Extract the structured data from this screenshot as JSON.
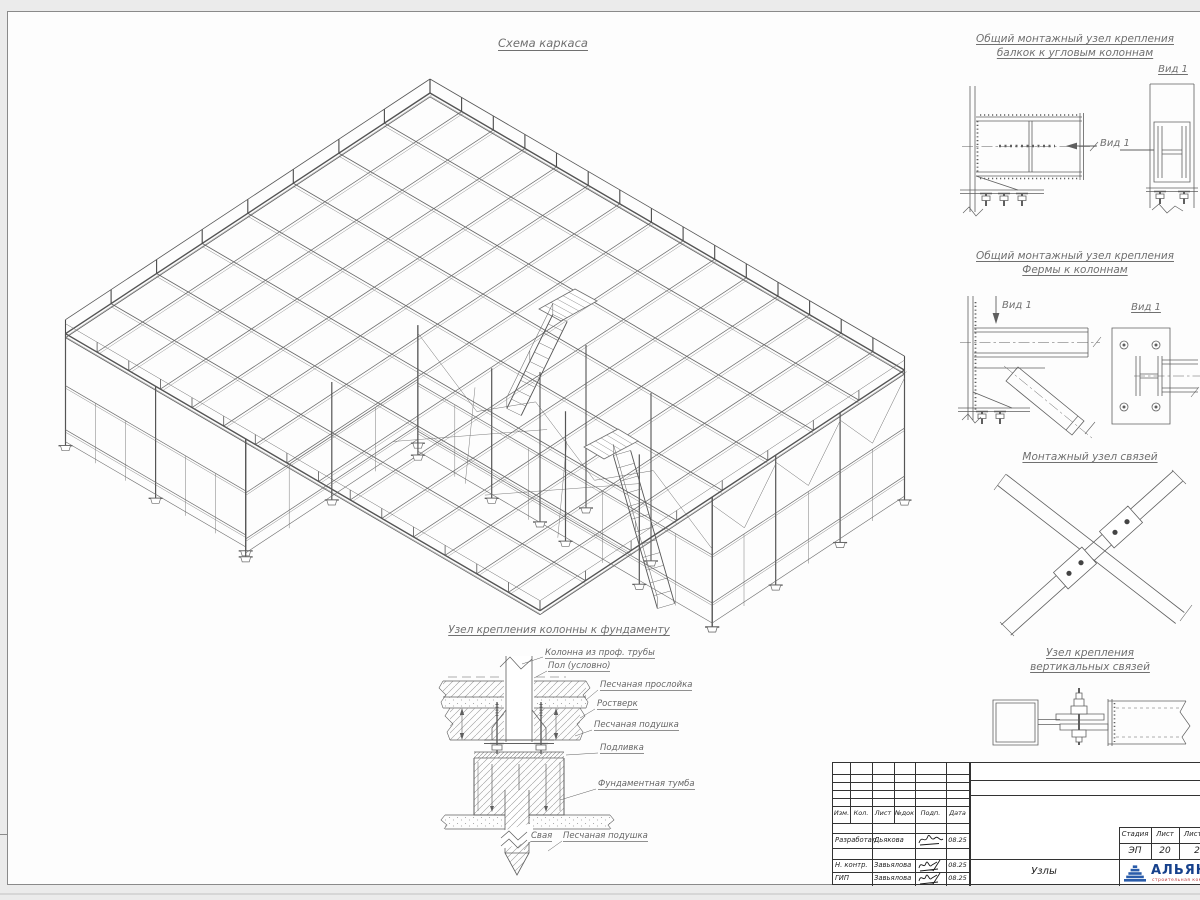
{
  "main_view": {
    "title": "Схема каркаса"
  },
  "details": [
    {
      "title_line1": "Общий монтажный узел крепления",
      "title_line2": "балкок к угловым колоннам",
      "view_label": "Вид 1",
      "arrow_label": "Вид 1"
    },
    {
      "title_line1": "Общий монтажный узел крепления",
      "title_line2": "Фермы к колоннам",
      "view_label": "Вид 1",
      "arrow_label": "Вид 1"
    },
    {
      "title_line1": "Монтажный узел связей",
      "title_line2": ""
    },
    {
      "title_line1": "Узел крепления",
      "title_line2": "вертикальных связей"
    }
  ],
  "foundation": {
    "title": "Узел крепления колонны к фундаменту",
    "labels": [
      "Колонна из проф. трубы",
      "Пол (условно)",
      "Песчаная прослойка",
      "Ростверк",
      "Песчаная подушка",
      "Подливка",
      "Фундаментная тумба",
      "Свая",
      "Песчаная подушка"
    ]
  },
  "title_block": {
    "columns": [
      "Изм.",
      "Кол.",
      "Лист",
      "№док",
      "Подп.",
      "Дата"
    ],
    "signature_rows": [
      {
        "role": "Разработал",
        "name": "Дьякова",
        "date": "08.25"
      },
      {
        "role": "Н. контр.",
        "name": "Завьялова",
        "date": "08.25"
      },
      {
        "role": "ГИП",
        "name": "Завьялова",
        "date": "08.25"
      }
    ],
    "stage_label": "Стадия",
    "sheet_label": "Лист",
    "total_label": "Листов",
    "stage_value": "ЭП",
    "sheet_value": "20",
    "total_value": "2",
    "sheet_title": "Узлы",
    "logo": {
      "name": "АЛЬЯНС",
      "tagline": "строительная компания"
    }
  },
  "colors": {
    "line": "#6e6e6e",
    "dark_line": "#555555",
    "logo_blue": "#2a5caa",
    "logo_text": "#16418c",
    "logo_red": "#c23b3b"
  }
}
